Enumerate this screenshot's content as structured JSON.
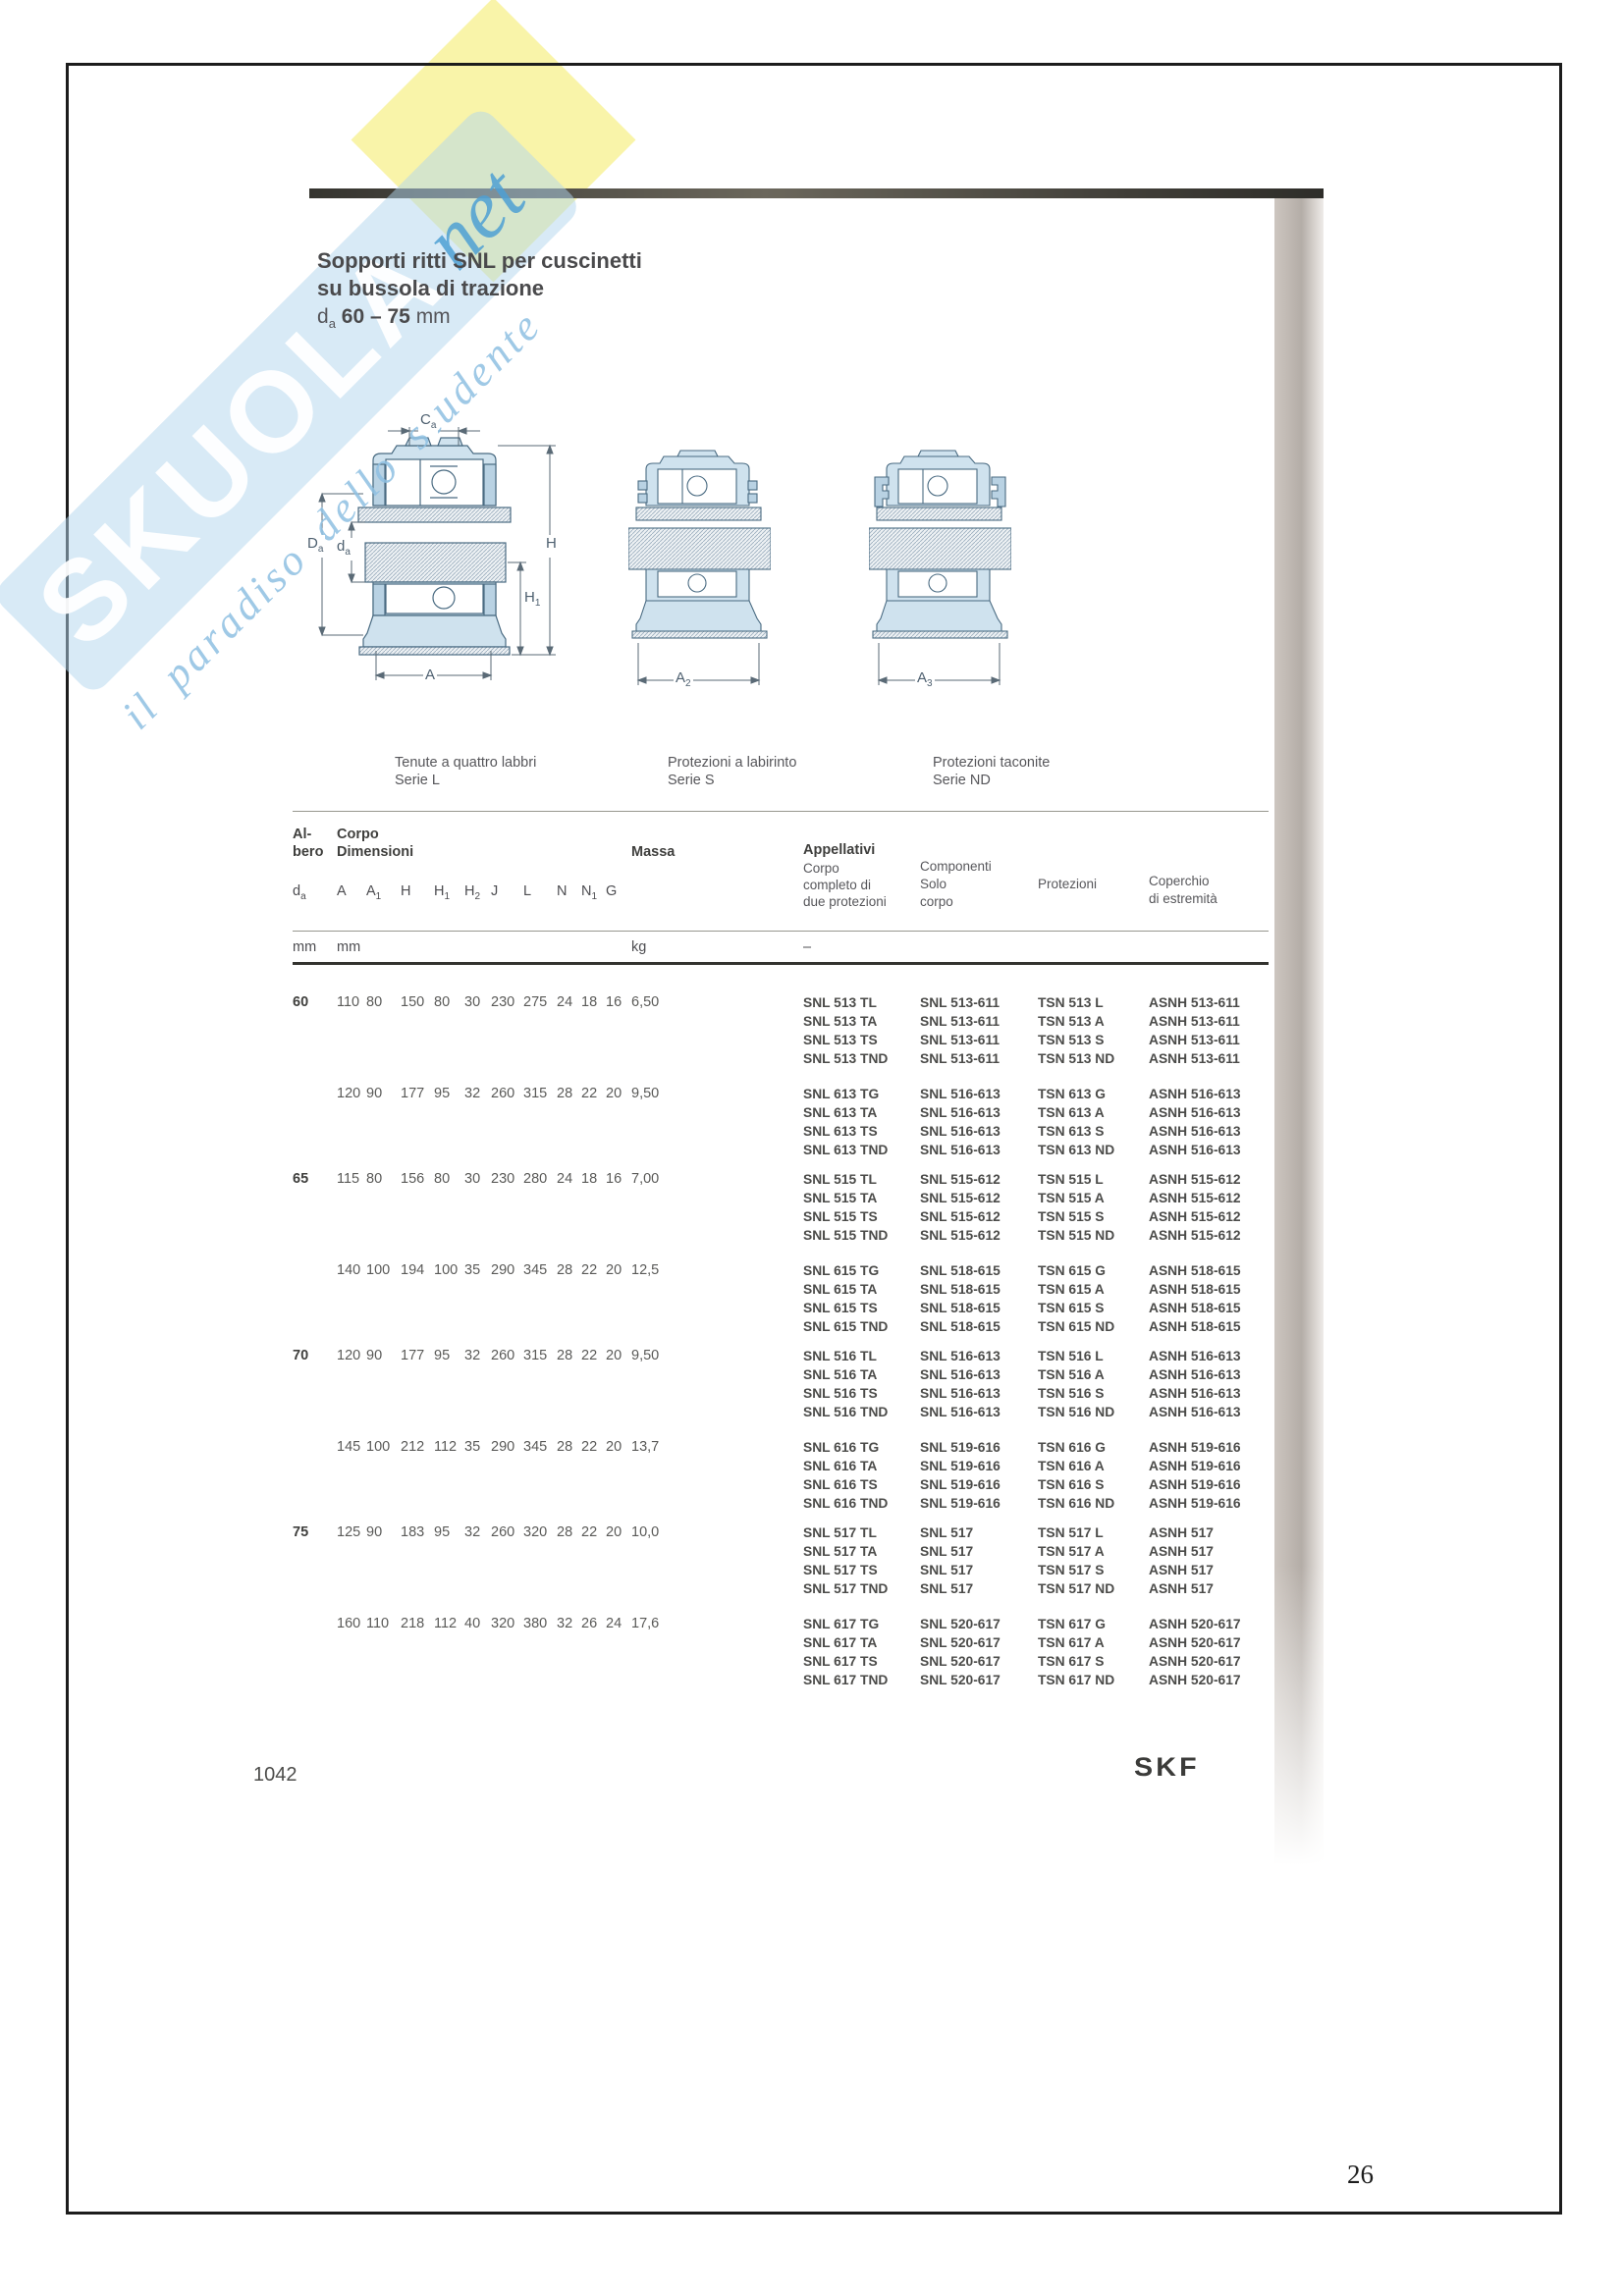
{
  "watermark": {
    "brand": "SKUOLA",
    "net": "net",
    "tagline": "il paradiso dello studente"
  },
  "colors": {
    "housing_fill": "#cfe2ee",
    "housing_stroke": "#4a6b82",
    "seal_fill": "#b9d2e3",
    "watermark_blue": "#b2d6ee",
    "watermark_yellow": "#f8f3a2"
  },
  "title": {
    "line1": "Sopporti ritti SNL per cuscinetti",
    "line2": "su bussola di trazione",
    "d_main": "d",
    "d_sub": "a",
    "range": "60 – 75",
    "unit": "mm"
  },
  "diagrams": {
    "labels": {
      "ca": {
        "m": "C",
        "s": "a"
      },
      "Da": {
        "m": "D",
        "s": "a"
      },
      "da": {
        "m": "d",
        "s": "a"
      },
      "h": {
        "m": "H",
        "s": ""
      },
      "h1": {
        "m": "H",
        "s": "1"
      },
      "a": {
        "m": "A",
        "s": ""
      },
      "a2": {
        "m": "A",
        "s": "2"
      },
      "a3": {
        "m": "A",
        "s": "3"
      }
    },
    "captions": [
      {
        "line1": "Tenute a quattro labbri",
        "line2": "Serie L"
      },
      {
        "line1": "Protezioni a labirinto",
        "line2": "Serie S"
      },
      {
        "line1": "Protezioni taconite",
        "line2": "Serie ND"
      }
    ]
  },
  "table": {
    "group_headers": {
      "shaft_l1": "Al-",
      "shaft_l2": "bero",
      "body_l1": "Corpo",
      "body_l2": "Dimensioni",
      "massa": "Massa",
      "appellativi": "Appellativi"
    },
    "columns": [
      {
        "m": "d",
        "s": "a"
      },
      {
        "m": "A",
        "s": ""
      },
      {
        "m": "A",
        "s": "1"
      },
      {
        "m": "H",
        "s": ""
      },
      {
        "m": "H",
        "s": "1"
      },
      {
        "m": "H",
        "s": "2"
      },
      {
        "m": "J",
        "s": ""
      },
      {
        "m": "L",
        "s": ""
      },
      {
        "m": "N",
        "s": ""
      },
      {
        "m": "N",
        "s": "1"
      },
      {
        "m": "G",
        "s": ""
      }
    ],
    "app_headers": [
      [
        "Corpo",
        "completo di",
        "due protezioni"
      ],
      [
        "Componenti",
        "Solo",
        "corpo"
      ],
      [
        "Protezioni"
      ],
      [
        "Coperchio",
        "di estremità"
      ]
    ],
    "units": {
      "shaft": "mm",
      "body": "mm",
      "massa": "kg",
      "appellativi": "–"
    },
    "blocks": [
      {
        "da": "60",
        "rows": [
          {
            "dims": [
              "110",
              "80",
              "150",
              "80",
              "30",
              "230",
              "275",
              "24",
              "18",
              "16"
            ],
            "massa": "6,50",
            "complete": [
              "SNL 513 TL",
              "SNL 513 TA",
              "SNL 513 TS",
              "SNL 513 TND"
            ],
            "solo": [
              "SNL 513-611",
              "SNL 513-611",
              "SNL 513-611",
              "SNL 513-611"
            ],
            "protezioni": [
              "TSN 513 L",
              "TSN 513 A",
              "TSN 513 S",
              "TSN 513 ND"
            ],
            "coperchio": [
              "ASNH 513-611",
              "ASNH 513-611",
              "ASNH 513-611",
              "ASNH 513-611"
            ]
          },
          {
            "dims": [
              "120",
              "90",
              "177",
              "95",
              "32",
              "260",
              "315",
              "28",
              "22",
              "20"
            ],
            "massa": "9,50",
            "complete": [
              "SNL 613 TG",
              "SNL 613 TA",
              "SNL 613 TS",
              "SNL 613 TND"
            ],
            "solo": [
              "SNL 516-613",
              "SNL 516-613",
              "SNL 516-613",
              "SNL 516-613"
            ],
            "protezioni": [
              "TSN 613 G",
              "TSN 613 A",
              "TSN 613 S",
              "TSN 613 ND"
            ],
            "coperchio": [
              "ASNH 516-613",
              "ASNH 516-613",
              "ASNH 516-613",
              "ASNH 516-613"
            ]
          }
        ]
      },
      {
        "da": "65",
        "rows": [
          {
            "dims": [
              "115",
              "80",
              "156",
              "80",
              "30",
              "230",
              "280",
              "24",
              "18",
              "16"
            ],
            "massa": "7,00",
            "complete": [
              "SNL 515 TL",
              "SNL 515 TA",
              "SNL 515 TS",
              "SNL 515 TND"
            ],
            "solo": [
              "SNL 515-612",
              "SNL 515-612",
              "SNL 515-612",
              "SNL 515-612"
            ],
            "protezioni": [
              "TSN 515 L",
              "TSN 515 A",
              "TSN 515 S",
              "TSN 515 ND"
            ],
            "coperchio": [
              "ASNH 515-612",
              "ASNH 515-612",
              "ASNH 515-612",
              "ASNH 515-612"
            ]
          },
          {
            "dims": [
              "140",
              "100",
              "194",
              "100",
              "35",
              "290",
              "345",
              "28",
              "22",
              "20"
            ],
            "massa": "12,5",
            "complete": [
              "SNL 615 TG",
              "SNL 615 TA",
              "SNL 615 TS",
              "SNL 615 TND"
            ],
            "solo": [
              "SNL 518-615",
              "SNL 518-615",
              "SNL 518-615",
              "SNL 518-615"
            ],
            "protezioni": [
              "TSN 615 G",
              "TSN 615 A",
              "TSN 615 S",
              "TSN 615 ND"
            ],
            "coperchio": [
              "ASNH 518-615",
              "ASNH 518-615",
              "ASNH 518-615",
              "ASNH 518-615"
            ]
          }
        ]
      },
      {
        "da": "70",
        "rows": [
          {
            "dims": [
              "120",
              "90",
              "177",
              "95",
              "32",
              "260",
              "315",
              "28",
              "22",
              "20"
            ],
            "massa": "9,50",
            "complete": [
              "SNL 516 TL",
              "SNL 516 TA",
              "SNL 516 TS",
              "SNL 516 TND"
            ],
            "solo": [
              "SNL 516-613",
              "SNL 516-613",
              "SNL 516-613",
              "SNL 516-613"
            ],
            "protezioni": [
              "TSN 516 L",
              "TSN 516 A",
              "TSN 516 S",
              "TSN 516 ND"
            ],
            "coperchio": [
              "ASNH 516-613",
              "ASNH 516-613",
              "ASNH 516-613",
              "ASNH 516-613"
            ]
          },
          {
            "dims": [
              "145",
              "100",
              "212",
              "112",
              "35",
              "290",
              "345",
              "28",
              "22",
              "20"
            ],
            "massa": "13,7",
            "complete": [
              "SNL 616 TG",
              "SNL 616 TA",
              "SNL 616 TS",
              "SNL 616 TND"
            ],
            "solo": [
              "SNL 519-616",
              "SNL 519-616",
              "SNL 519-616",
              "SNL 519-616"
            ],
            "protezioni": [
              "TSN 616 G",
              "TSN 616 A",
              "TSN 616 S",
              "TSN 616 ND"
            ],
            "coperchio": [
              "ASNH 519-616",
              "ASNH 519-616",
              "ASNH 519-616",
              "ASNH 519-616"
            ]
          }
        ]
      },
      {
        "da": "75",
        "rows": [
          {
            "dims": [
              "125",
              "90",
              "183",
              "95",
              "32",
              "260",
              "320",
              "28",
              "22",
              "20"
            ],
            "massa": "10,0",
            "complete": [
              "SNL 517 TL",
              "SNL 517 TA",
              "SNL 517 TS",
              "SNL 517 TND"
            ],
            "solo": [
              "SNL 517",
              "SNL 517",
              "SNL 517",
              "SNL 517"
            ],
            "protezioni": [
              "TSN 517 L",
              "TSN 517 A",
              "TSN 517 S",
              "TSN 517 ND"
            ],
            "coperchio": [
              "ASNH 517",
              "ASNH 517",
              "ASNH 517",
              "ASNH 517"
            ]
          },
          {
            "dims": [
              "160",
              "110",
              "218",
              "112",
              "40",
              "320",
              "380",
              "32",
              "26",
              "24"
            ],
            "massa": "17,6",
            "complete": [
              "SNL 617 TG",
              "SNL 617 TA",
              "SNL 617 TS",
              "SNL 617 TND"
            ],
            "solo": [
              "SNL 520-617",
              "SNL 520-617",
              "SNL 520-617",
              "SNL 520-617"
            ],
            "protezioni": [
              "TSN 617 G",
              "TSN 617 A",
              "TSN 617 S",
              "TSN 617 ND"
            ],
            "coperchio": [
              "ASNH 520-617",
              "ASNH 520-617",
              "ASNH 520-617",
              "ASNH 520-617"
            ]
          }
        ]
      }
    ]
  },
  "footer": {
    "catalog_page": "1042",
    "logo": "SKF"
  },
  "scan": {
    "page_number": "26"
  }
}
